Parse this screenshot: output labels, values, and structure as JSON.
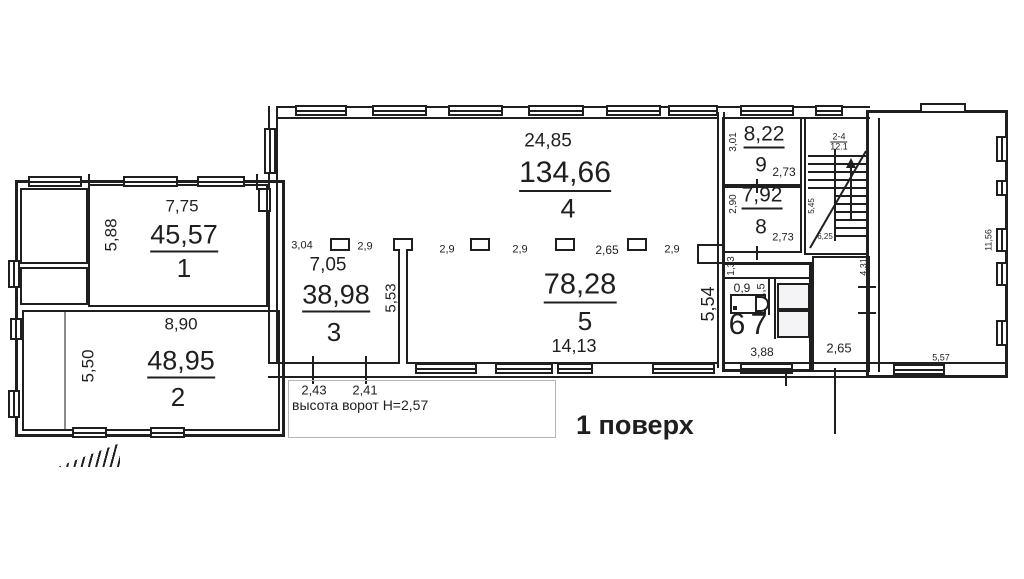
{
  "meta": {
    "floor_label": "1 поверх",
    "gate_note": "высота ворот Н=2,57"
  },
  "colors": {
    "line": "#1f1f1f",
    "background": "#ffffff",
    "callout_border": "#b5b5b5"
  },
  "rooms": {
    "r1": {
      "number": "1",
      "area": "45,57",
      "dim_width": "7,75",
      "dim_depth": "5,88"
    },
    "r2": {
      "number": "2",
      "area": "48,95",
      "dim_width": "8,90",
      "dim_depth": "5,50"
    },
    "r3": {
      "number": "3",
      "area": "38,98",
      "dim_width": "7,05"
    },
    "r4": {
      "number": "4",
      "area": "134,66",
      "dim_width": "24,85"
    },
    "r5": {
      "number": "5",
      "area": "78,28",
      "dim_width": "14,13",
      "dim_depth": "5,54"
    },
    "r6": {
      "number": "6",
      "dim_width": "0,9"
    },
    "r7": {
      "number": "7",
      "dim_width": "1,5",
      "dim_depth": "3,88"
    },
    "r8": {
      "number": "8",
      "area": "7,92",
      "dim_depth": "2,90",
      "dim_width": "2,73"
    },
    "r9": {
      "number": "9",
      "area": "8,22",
      "dim_depth": "3,01",
      "dim_width": "2,73"
    },
    "storage": {
      "dim_width": "2,65",
      "dim_wall": "4,31"
    },
    "right_hall": {
      "dim_side": "11,56",
      "dim_bottom": "5,57"
    }
  },
  "column_grid": {
    "spacings": [
      "3,04",
      "2,9",
      "2,9",
      "2,9",
      "2,65",
      "2,9"
    ],
    "partition_depth": "5,53"
  },
  "wc_block": {
    "passage_width": "1,33"
  },
  "gates": {
    "gate_1": "2,43",
    "gate_2": "2,41"
  },
  "stairs": {
    "flight_label": "2-4",
    "flight_sublabel": "12.1",
    "dim_depth": "5,45",
    "dim_width": "6,25"
  }
}
